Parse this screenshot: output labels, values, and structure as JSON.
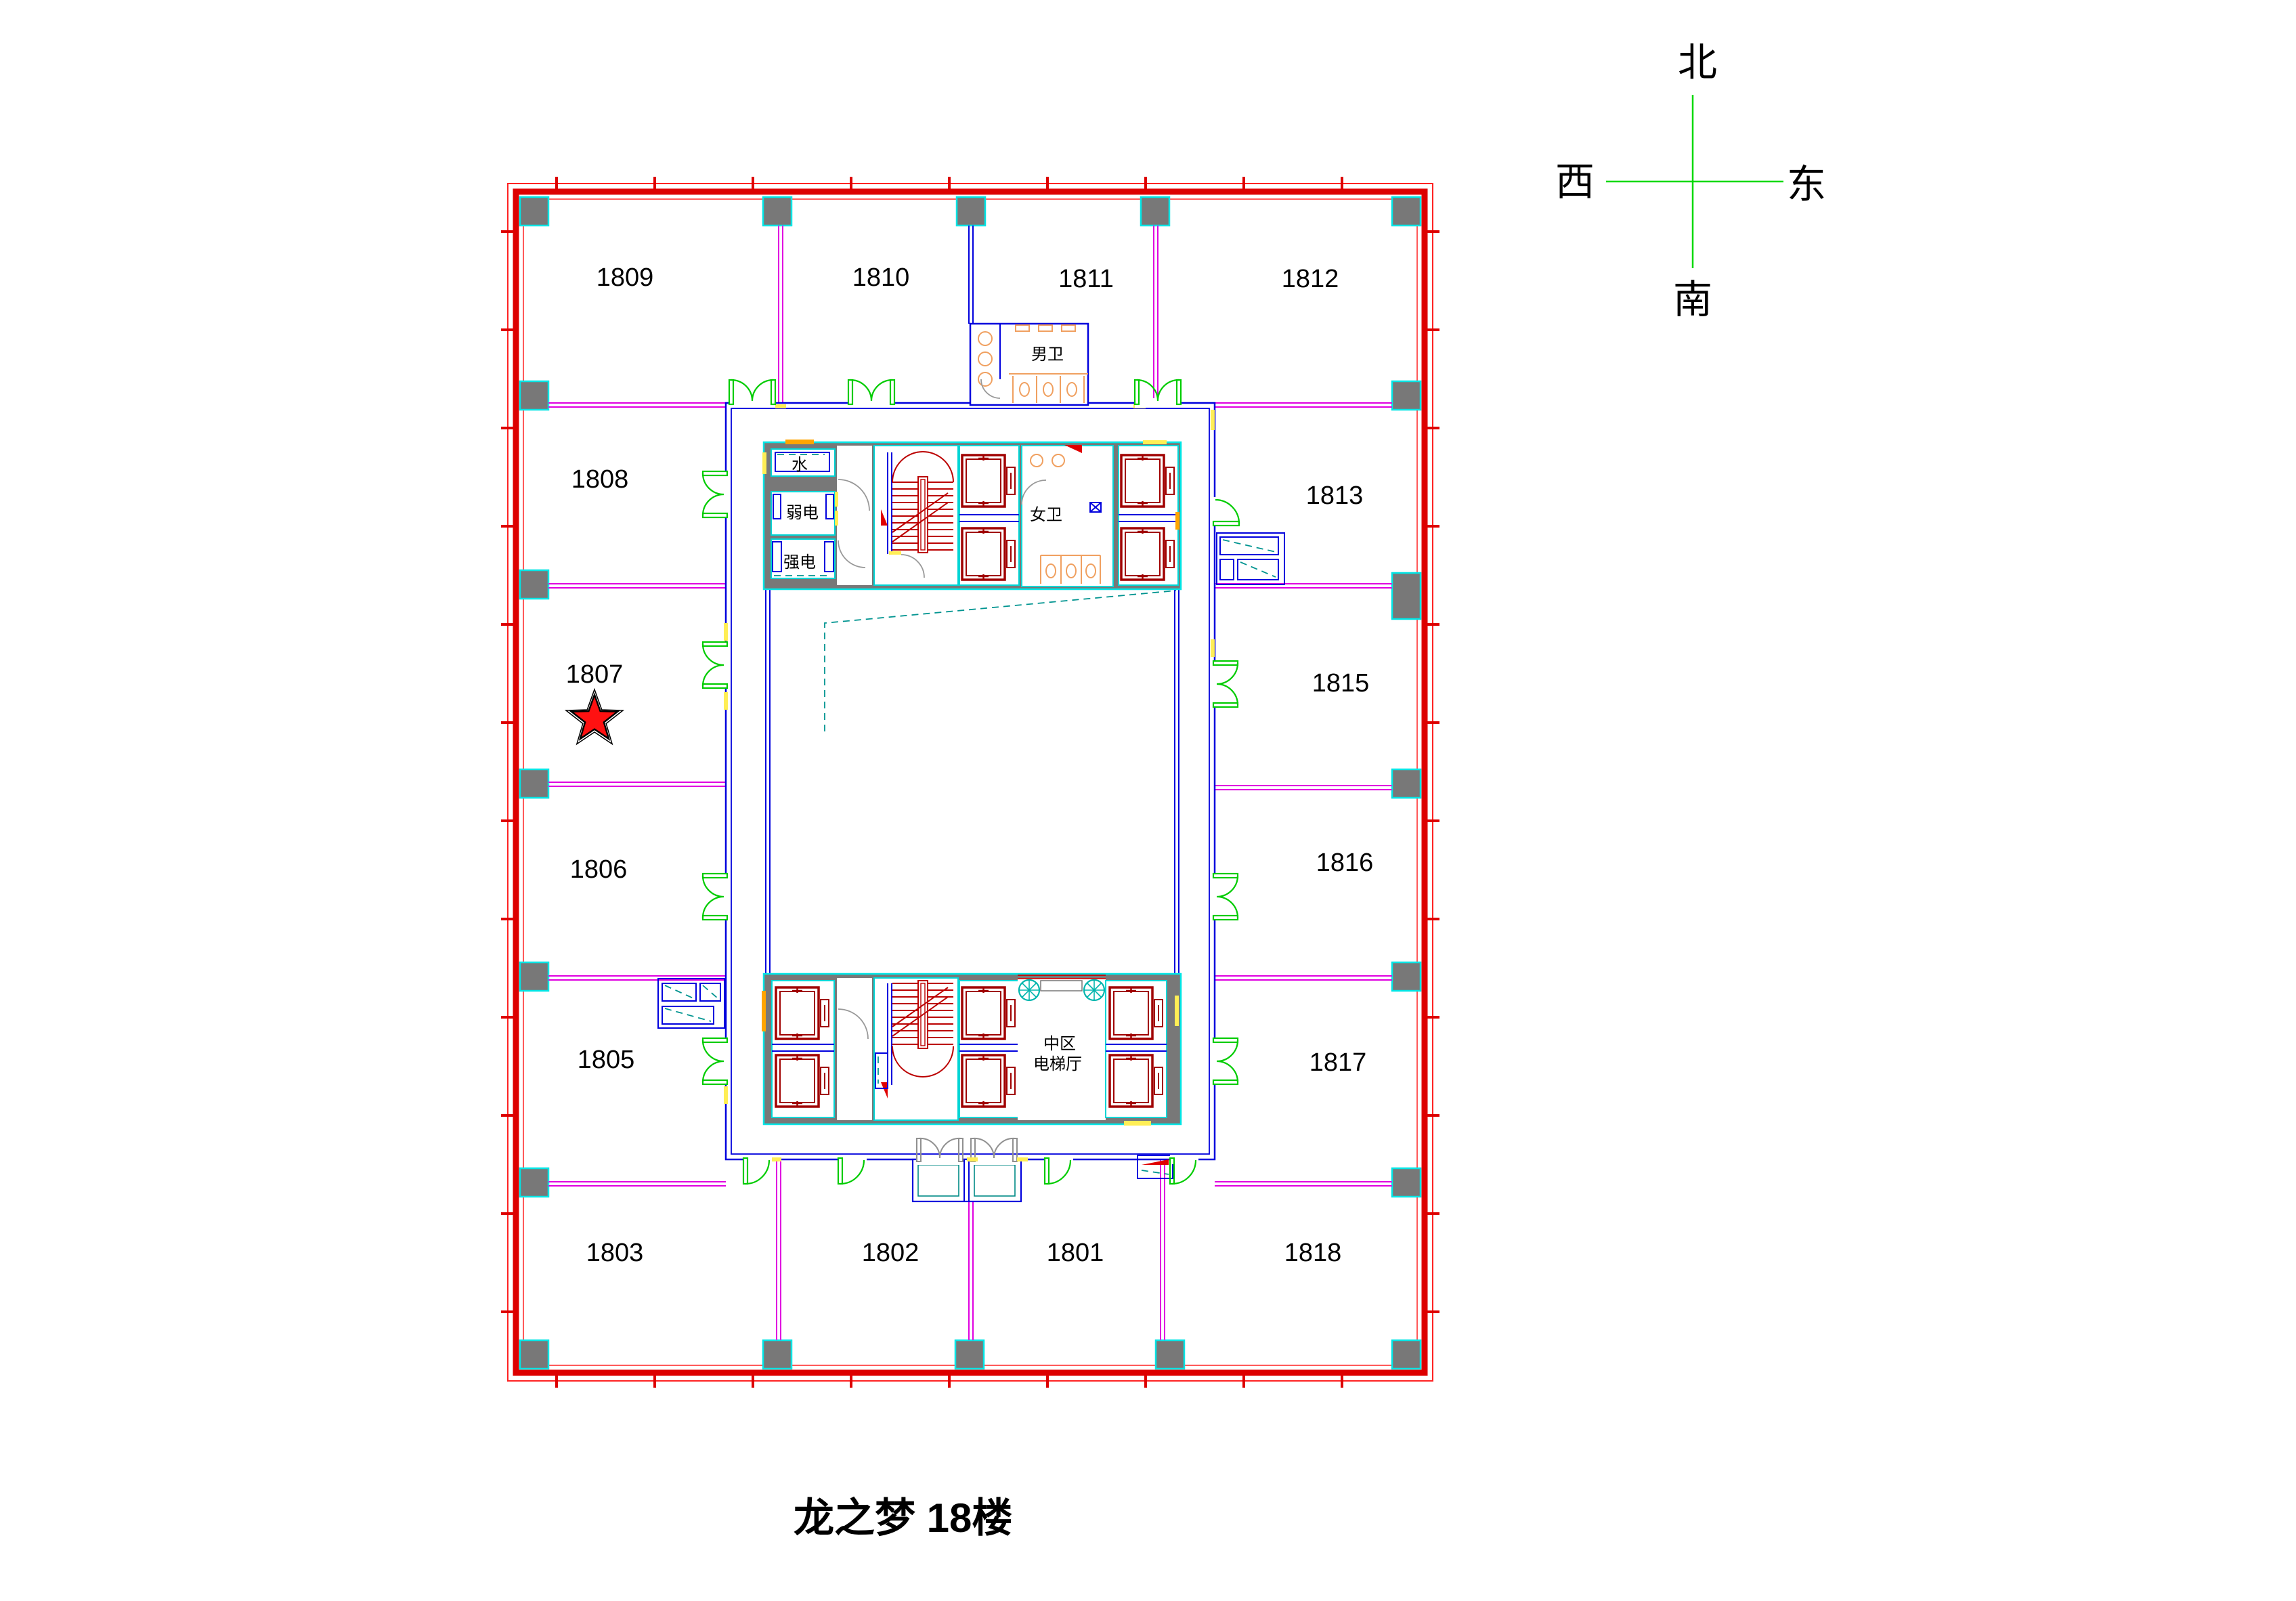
{
  "title": "龙之梦  18楼",
  "compass": {
    "north": "北",
    "south": "南",
    "east": "东",
    "west": "西"
  },
  "rooms": [
    "1801",
    "1802",
    "1803",
    "1805",
    "1806",
    "1807",
    "1808",
    "1809",
    "1810",
    "1811",
    "1812",
    "1813",
    "1815",
    "1816",
    "1817",
    "1818"
  ],
  "starred_room": "1807",
  "core": {
    "men_toilet": "男卫",
    "women_toilet": "女卫",
    "water_room": "水",
    "weak_electric_room": "弱电",
    "strong_electric_room": "强电",
    "elevator_hall_line1": "中区",
    "elevator_hall_line2": "电梯厅"
  },
  "colors": {
    "boundary_wall": "#dd0000",
    "partition": "#e000e0",
    "corridor_wall": "#0000dd",
    "column_fill": "#787878",
    "column_border": "#00e5e5",
    "door": "#00cc00",
    "elevator": "#a00000",
    "stair": "#bb0000",
    "fixture": "#f0a060",
    "detail_dash": "#009490",
    "accent_yellow": "#ffee55",
    "accent_orange": "#ffa500",
    "star": "#ff1111",
    "compass_line": "#00d900"
  }
}
